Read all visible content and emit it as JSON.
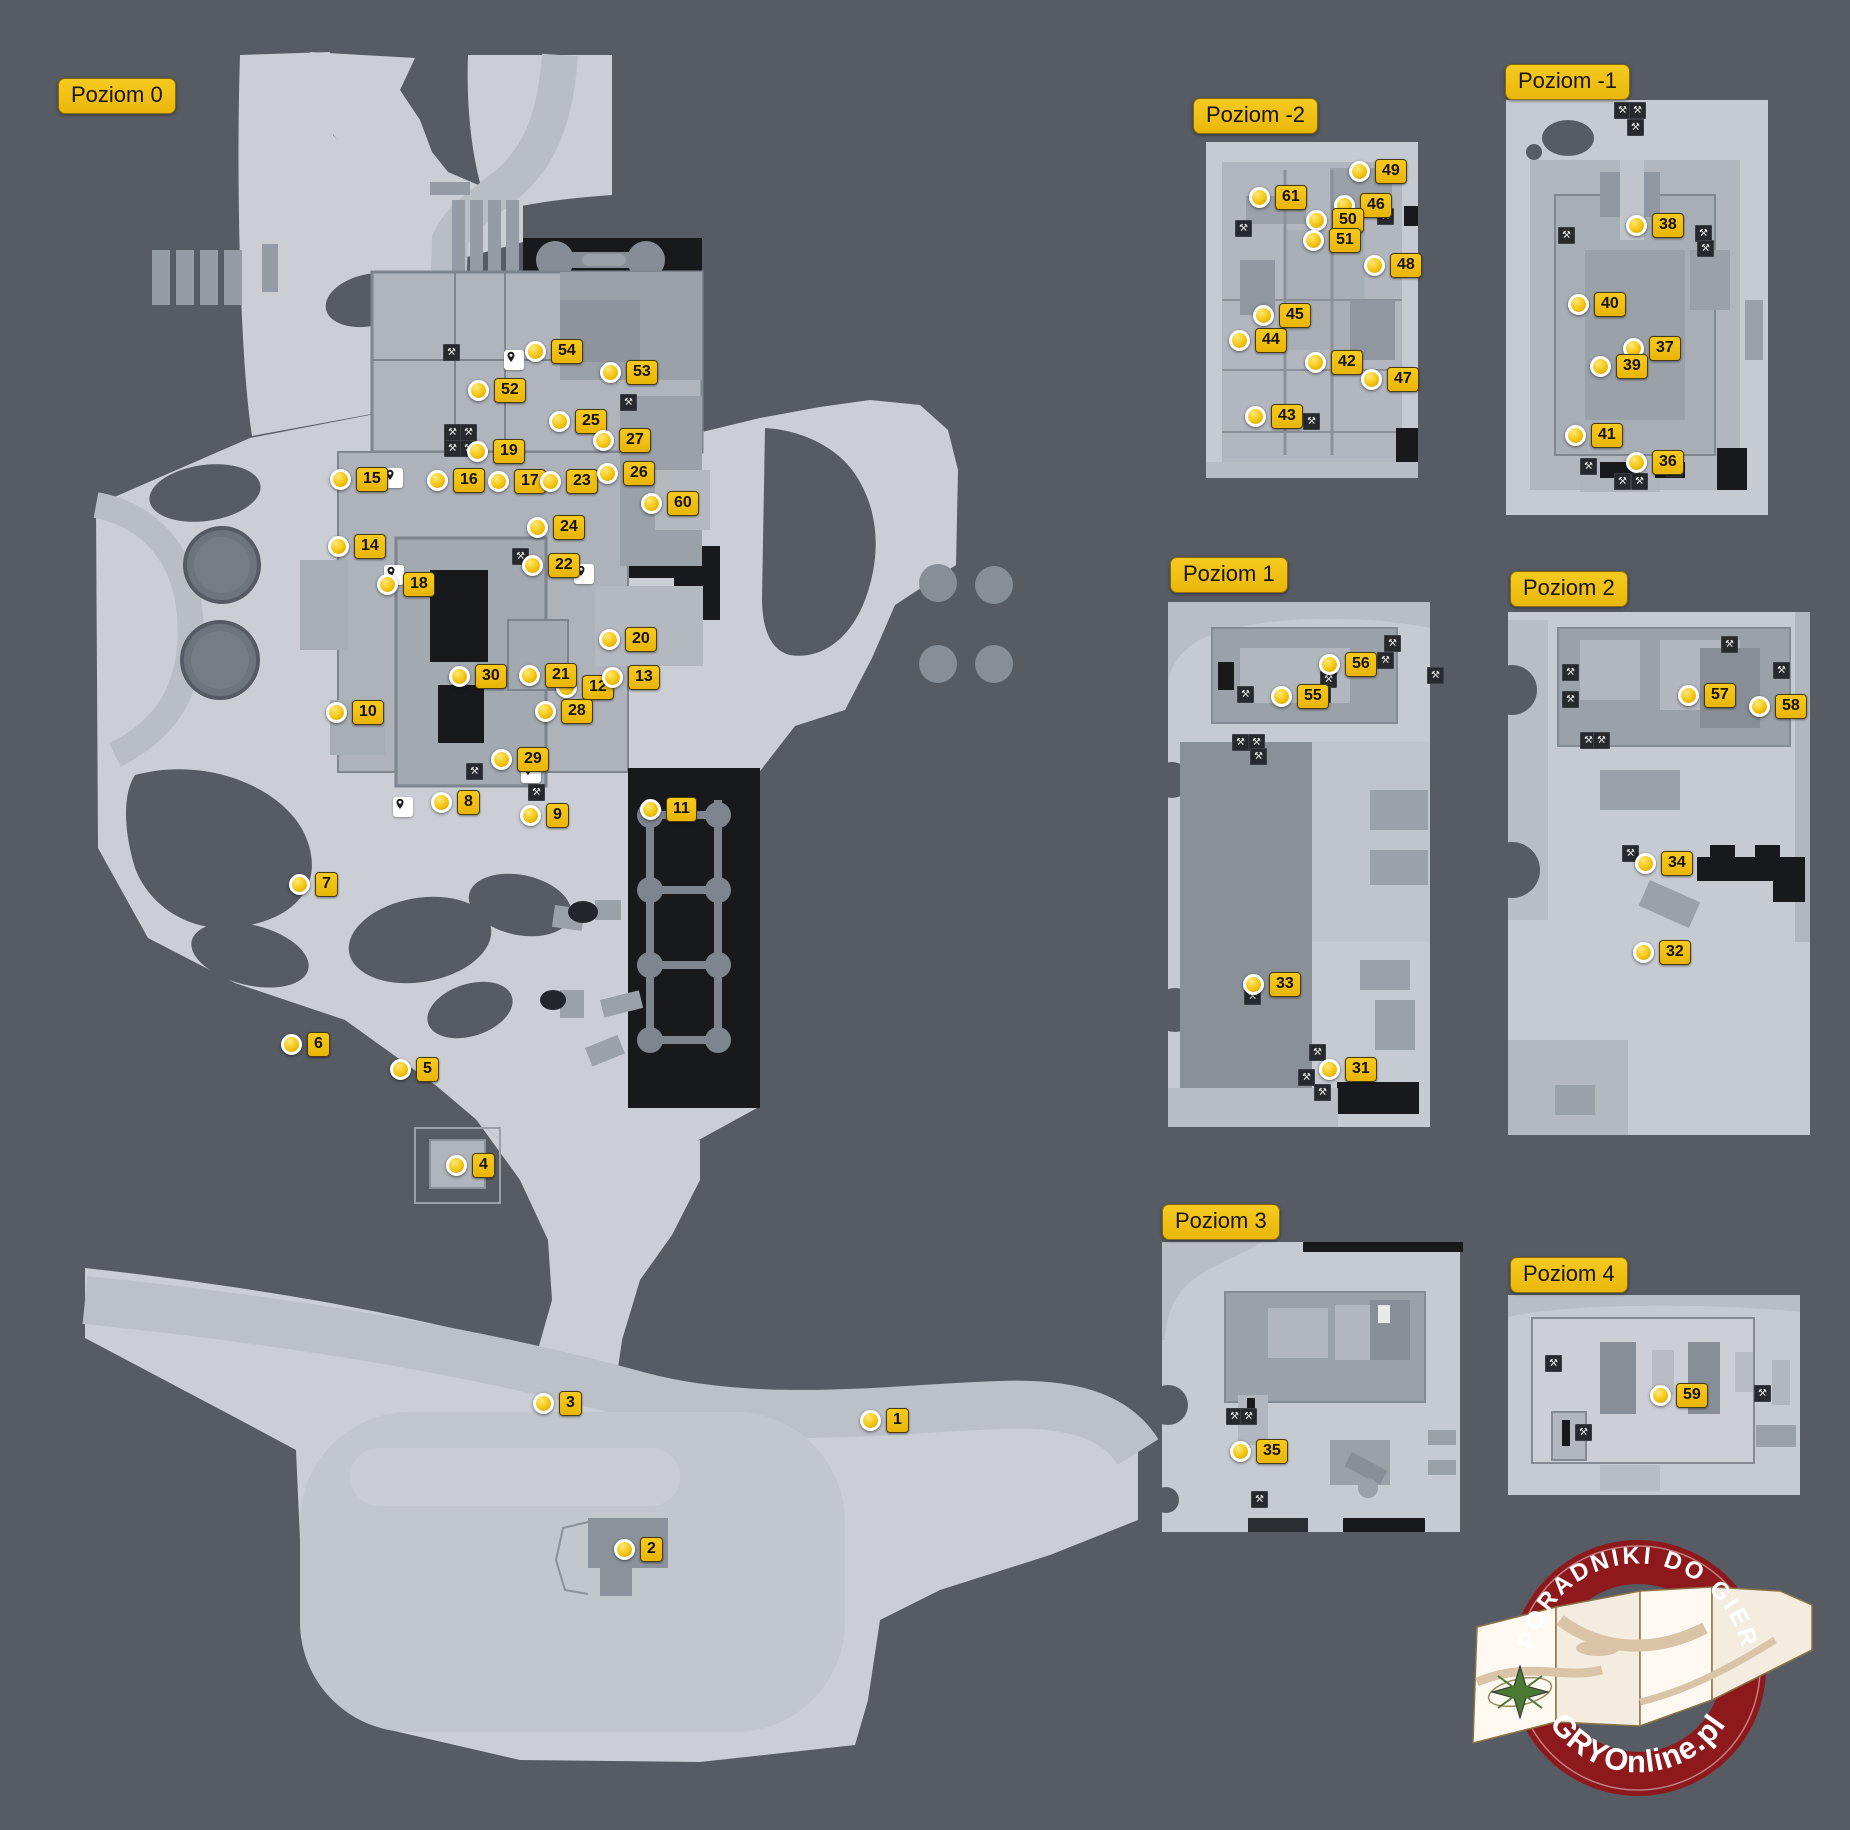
{
  "colors": {
    "background": "#575b64",
    "land": "#cbcfd5",
    "land_light": "#c6cbd1",
    "road": "#b9bec5",
    "road_light": "#c2c7cd",
    "building": "#9aa1a9",
    "building_dark": "#878e97",
    "floor": "#b2b7bf",
    "black": "#17191c",
    "column_gray": "#7f858e",
    "marker_yellow": "#f3c50e",
    "label_yellow": "#f0bd10",
    "logo_red": "#8e191c",
    "logo_paper": "#fdf9f1"
  },
  "levels": [
    {
      "id": "poziom-0",
      "label": "Poziom 0",
      "x": 58,
      "y": 78
    },
    {
      "id": "poziom-minus2",
      "label": "Poziom -2",
      "x": 1193,
      "y": 98
    },
    {
      "id": "poziom-minus1",
      "label": "Poziom -1",
      "x": 1505,
      "y": 64
    },
    {
      "id": "poziom-1",
      "label": "Poziom 1",
      "x": 1170,
      "y": 557
    },
    {
      "id": "poziom-2",
      "label": "Poziom 2",
      "x": 1510,
      "y": 571
    },
    {
      "id": "poziom-3",
      "label": "Poziom 3",
      "x": 1162,
      "y": 1204
    },
    {
      "id": "poziom-4",
      "label": "Poziom 4",
      "x": 1510,
      "y": 1257
    }
  ],
  "markers": [
    {
      "n": "1",
      "level": "poziom-0",
      "x": 869,
      "y": 1418
    },
    {
      "n": "2",
      "level": "poziom-0",
      "x": 623,
      "y": 1547
    },
    {
      "n": "3",
      "level": "poziom-0",
      "x": 542,
      "y": 1401
    },
    {
      "n": "4",
      "level": "poziom-0",
      "x": 455,
      "y": 1163
    },
    {
      "n": "5",
      "level": "poziom-0",
      "x": 399,
      "y": 1067
    },
    {
      "n": "6",
      "level": "poziom-0",
      "x": 290,
      "y": 1042
    },
    {
      "n": "7",
      "level": "poziom-0",
      "x": 298,
      "y": 882
    },
    {
      "n": "8",
      "level": "poziom-0",
      "x": 440,
      "y": 800
    },
    {
      "n": "9",
      "level": "poziom-0",
      "x": 529,
      "y": 813
    },
    {
      "n": "10",
      "level": "poziom-0",
      "x": 335,
      "y": 710
    },
    {
      "n": "11",
      "level": "poziom-0",
      "x": 649,
      "y": 807
    },
    {
      "n": "12",
      "level": "poziom-0",
      "x": 565,
      "y": 685
    },
    {
      "n": "13",
      "level": "poziom-0",
      "x": 611,
      "y": 675
    },
    {
      "n": "14",
      "level": "poziom-0",
      "x": 337,
      "y": 544
    },
    {
      "n": "15",
      "level": "poziom-0",
      "x": 339,
      "y": 477
    },
    {
      "n": "16",
      "level": "poziom-0",
      "x": 436,
      "y": 478
    },
    {
      "n": "17",
      "level": "poziom-0",
      "x": 497,
      "y": 479
    },
    {
      "n": "18",
      "level": "poziom-0",
      "x": 386,
      "y": 582
    },
    {
      "n": "19",
      "level": "poziom-0",
      "x": 476,
      "y": 449
    },
    {
      "n": "20",
      "level": "poziom-0",
      "x": 608,
      "y": 637
    },
    {
      "n": "21",
      "level": "poziom-0",
      "x": 528,
      "y": 673
    },
    {
      "n": "22",
      "level": "poziom-0",
      "x": 531,
      "y": 563
    },
    {
      "n": "23",
      "level": "poziom-0",
      "x": 549,
      "y": 479
    },
    {
      "n": "24",
      "level": "poziom-0",
      "x": 536,
      "y": 525
    },
    {
      "n": "25",
      "level": "poziom-0",
      "x": 558,
      "y": 419
    },
    {
      "n": "26",
      "level": "poziom-0",
      "x": 606,
      "y": 471
    },
    {
      "n": "27",
      "level": "poziom-0",
      "x": 602,
      "y": 438
    },
    {
      "n": "28",
      "level": "poziom-0",
      "x": 544,
      "y": 709
    },
    {
      "n": "29",
      "level": "poziom-0",
      "x": 500,
      "y": 757
    },
    {
      "n": "30",
      "level": "poziom-0",
      "x": 458,
      "y": 674
    },
    {
      "n": "31",
      "level": "poziom-1",
      "x": 1328,
      "y": 1067
    },
    {
      "n": "32",
      "level": "poziom-2",
      "x": 1642,
      "y": 950
    },
    {
      "n": "33",
      "level": "poziom-1",
      "x": 1252,
      "y": 982
    },
    {
      "n": "34",
      "level": "poziom-2",
      "x": 1644,
      "y": 861
    },
    {
      "n": "35",
      "level": "poziom-3",
      "x": 1239,
      "y": 1449
    },
    {
      "n": "36",
      "level": "poziom-minus1",
      "x": 1635,
      "y": 460
    },
    {
      "n": "37",
      "level": "poziom-minus1",
      "x": 1632,
      "y": 346
    },
    {
      "n": "38",
      "level": "poziom-minus1",
      "x": 1635,
      "y": 223
    },
    {
      "n": "39",
      "level": "poziom-minus1",
      "x": 1599,
      "y": 364
    },
    {
      "n": "40",
      "level": "poziom-minus1",
      "x": 1577,
      "y": 302
    },
    {
      "n": "41",
      "level": "poziom-minus1",
      "x": 1574,
      "y": 433
    },
    {
      "n": "42",
      "level": "poziom-minus2",
      "x": 1314,
      "y": 360
    },
    {
      "n": "43",
      "level": "poziom-minus2",
      "x": 1254,
      "y": 414
    },
    {
      "n": "44",
      "level": "poziom-minus2",
      "x": 1238,
      "y": 338
    },
    {
      "n": "45",
      "level": "poziom-minus2",
      "x": 1262,
      "y": 313
    },
    {
      "n": "46",
      "level": "poziom-minus2",
      "x": 1343,
      "y": 203
    },
    {
      "n": "47",
      "level": "poziom-minus2",
      "x": 1370,
      "y": 377
    },
    {
      "n": "48",
      "level": "poziom-minus2",
      "x": 1373,
      "y": 263
    },
    {
      "n": "49",
      "level": "poziom-minus2",
      "x": 1358,
      "y": 169
    },
    {
      "n": "50",
      "level": "poziom-minus2",
      "x": 1315,
      "y": 218
    },
    {
      "n": "51",
      "level": "poziom-minus2",
      "x": 1312,
      "y": 238
    },
    {
      "n": "52",
      "level": "poziom-0",
      "x": 477,
      "y": 388
    },
    {
      "n": "53",
      "level": "poziom-0",
      "x": 609,
      "y": 370
    },
    {
      "n": "54",
      "level": "poziom-0",
      "x": 534,
      "y": 349
    },
    {
      "n": "55",
      "level": "poziom-1",
      "x": 1280,
      "y": 694
    },
    {
      "n": "56",
      "level": "poziom-1",
      "x": 1328,
      "y": 662
    },
    {
      "n": "57",
      "level": "poziom-2",
      "x": 1687,
      "y": 693
    },
    {
      "n": "58",
      "level": "poziom-2",
      "x": 1758,
      "y": 704
    },
    {
      "n": "59",
      "level": "poziom-4",
      "x": 1659,
      "y": 1393
    },
    {
      "n": "60",
      "level": "poziom-0",
      "x": 650,
      "y": 501
    },
    {
      "n": "61",
      "level": "poziom-minus2",
      "x": 1258,
      "y": 195
    }
  ],
  "pins": [
    [
      514,
      360
    ],
    [
      393,
      478
    ],
    [
      394,
      575
    ],
    [
      584,
      574
    ],
    [
      531,
      773
    ],
    [
      403,
      807
    ]
  ],
  "workbenches": [
    [
      451,
      352
    ],
    [
      452,
      432
    ],
    [
      468,
      432
    ],
    [
      452,
      448
    ],
    [
      468,
      448
    ],
    [
      628,
      402
    ],
    [
      520,
      556
    ],
    [
      474,
      771
    ],
    [
      536,
      792
    ],
    [
      1243,
      228
    ],
    [
      1311,
      421
    ],
    [
      1385,
      216
    ],
    [
      1622,
      110
    ],
    [
      1637,
      110
    ],
    [
      1635,
      127
    ],
    [
      1566,
      235
    ],
    [
      1703,
      233
    ],
    [
      1705,
      248
    ],
    [
      1588,
      466
    ],
    [
      1674,
      468
    ],
    [
      1622,
      481
    ],
    [
      1639,
      481
    ],
    [
      1392,
      643
    ],
    [
      1385,
      660
    ],
    [
      1435,
      675
    ],
    [
      1328,
      679
    ],
    [
      1322,
      694
    ],
    [
      1245,
      694
    ],
    [
      1240,
      742
    ],
    [
      1256,
      742
    ],
    [
      1258,
      756
    ],
    [
      1252,
      996
    ],
    [
      1317,
      1052
    ],
    [
      1306,
      1077
    ],
    [
      1322,
      1092
    ],
    [
      1570,
      672
    ],
    [
      1570,
      699
    ],
    [
      1729,
      644
    ],
    [
      1781,
      670
    ],
    [
      1588,
      740
    ],
    [
      1601,
      740
    ],
    [
      1630,
      853
    ],
    [
      1684,
      865
    ],
    [
      1234,
      1416
    ],
    [
      1248,
      1416
    ],
    [
      1259,
      1499
    ],
    [
      1553,
      1363
    ],
    [
      1762,
      1393
    ],
    [
      1583,
      1432
    ]
  ],
  "logo": {
    "top_text": "PORADNIKI DO GIER",
    "bottom_text": "GRYOnline.pl"
  }
}
